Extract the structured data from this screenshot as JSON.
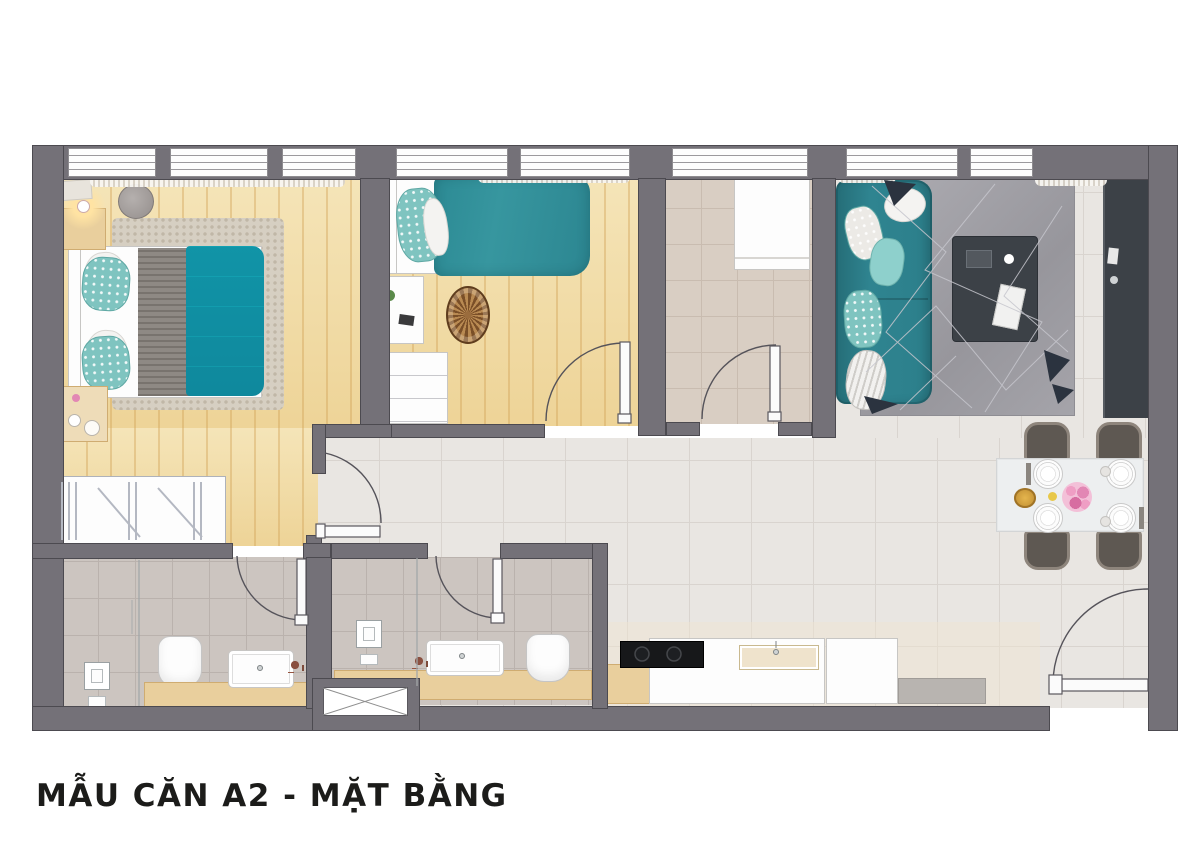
{
  "title": "MẪU CĂN A2 - MẶT BẰNG",
  "palette": {
    "pageBg": "#ffffff",
    "wall": "#747178",
    "wallEdge": "#4c4a50",
    "wood": "#f2dda4",
    "tile": "#e9e6e2",
    "tileLine": "#d9d4cf",
    "bathTile": "#ccc5c0",
    "bathTileLine": "#bab2ad",
    "laundryTile": "#d9cec3",
    "laundryTileLine": "#c9bcb0",
    "teal": "#2e8591",
    "tealDeep": "#256d77",
    "rugLiving": "#a3a2a8",
    "rugBed": "#d6cfc2",
    "charcoal": "#3c4147",
    "blanket": "#8e8984",
    "furnWood": "#e9cf9d",
    "furnWoodEdge": "#cfac71",
    "chair": "#5e5852",
    "chairEdge": "#8e857c",
    "table": "#edeff0",
    "accentPink": "#e287b4",
    "accentGold": "#d9a43a",
    "titleColor": "#1c1c1a"
  }
}
